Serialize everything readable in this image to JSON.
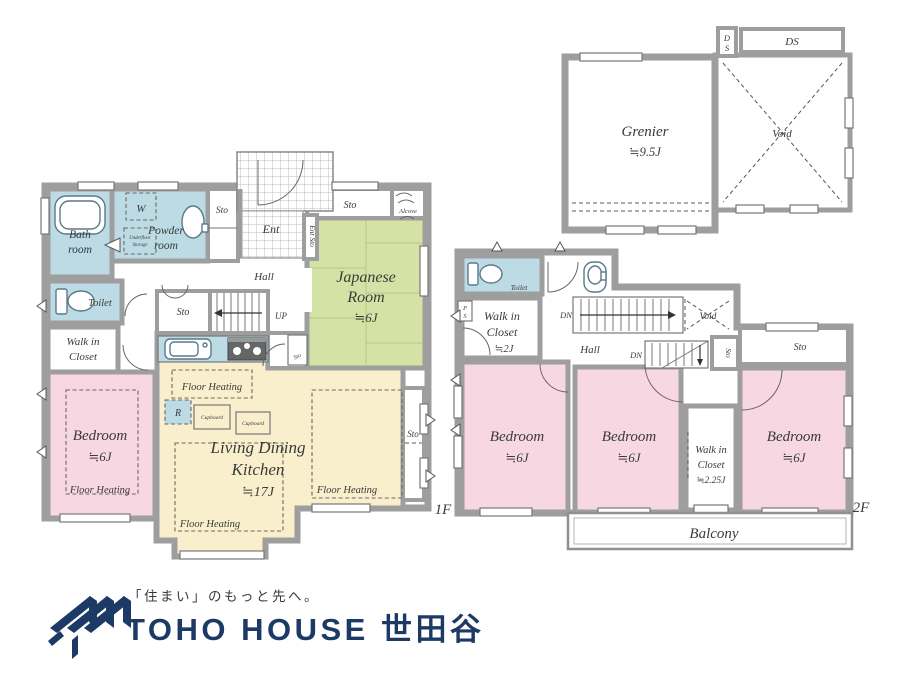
{
  "colors": {
    "wall": "#9e9e9e",
    "water_blue": "#bcdbe5",
    "tatami_green": "#d4e3a5",
    "bedroom_pink": "#f7d7e1",
    "ldk_cream": "#f9efcd",
    "logo_navy": "#1d3a66",
    "text": "#3a3a3a"
  },
  "floor1": {
    "floor_label": "1F",
    "bath_1": "Bath",
    "bath_2": "room",
    "powder_1": "Powder",
    "powder_2": "room",
    "washer": "W",
    "underfloor_1": "Underfloor",
    "underfloor_2": "Storage",
    "sto": "Sto",
    "toilet": "Toilet",
    "wic_1": "Walk in",
    "wic_2": "Closet",
    "bedroom": "Bedroom",
    "bedroom_size": "≒6J",
    "floor_heating": "Floor Heating",
    "ent": "Ent",
    "ent_sto": "Ent Sto",
    "hall": "Hall",
    "up": "UP",
    "ldk_1": "Living Dining",
    "ldk_2": "Kitchen",
    "ldk_size": "≒17J",
    "fridge": "R",
    "cupboard": "Cupboard",
    "japanese_1": "Japanese",
    "japanese_2": "Room",
    "japanese_size": "≒6J",
    "alcove": "Alcove"
  },
  "floor2": {
    "floor_label": "2F",
    "grenier": "Grenier",
    "grenier_size": "≒9.5J",
    "void": "Void",
    "ds": "DS",
    "ds_d": "D",
    "ds_s": "S",
    "toilet": "Toilet",
    "ps_p": "P",
    "ps_s": "S",
    "wic_1": "Walk in",
    "wic_2": "Closet",
    "wic_size": "≒2J",
    "hall": "Hall",
    "dn": "DN",
    "sto": "Sto",
    "bedroom": "Bedroom",
    "bedroom_size": "≒6J",
    "wic225_1": "Walk in",
    "wic225_2": "Closet",
    "wic225_size": "≒2.25J",
    "balcony": "Balcony"
  },
  "logo": {
    "tagline": "「住まい」のもっと先へ。",
    "brand": "TOHO HOUSE 世田谷"
  }
}
